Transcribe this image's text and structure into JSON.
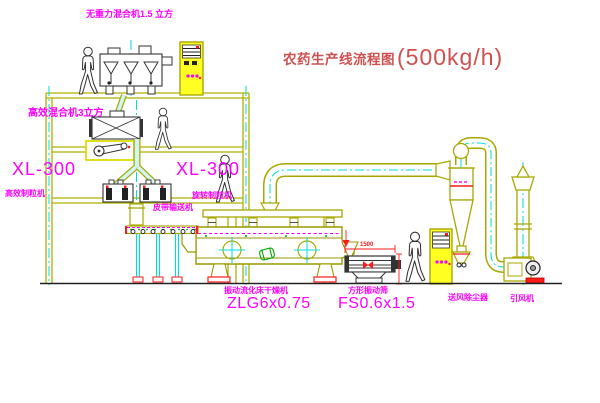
{
  "title": {
    "name": "农药生产线流程图",
    "capacity": "(500kg/h)"
  },
  "labels": {
    "top_mixer": "无重力混合机1.5 立方",
    "floor_mixer": "高效混合机3立方",
    "granulator_left_model": "XL-300",
    "granulator_left_name": "高效制粒机",
    "granulator_right_model": "XL-300",
    "granulator_right_name": "旋转制粒机",
    "belt_conveyor": "皮带输送机",
    "dryer_name": "振动流化床干燥机",
    "dryer_model": "ZLG6x0.75",
    "sieve_name": "方形振动筛",
    "sieve_model": "FS0.6x1.5",
    "sieve_dim_width": "1500",
    "dust_collector": "送风除尘器",
    "fan": "引风机"
  },
  "colors": {
    "structure_yellow": "#B0B000",
    "label_magenta": "#FF00FF",
    "centerline_cyan": "#00DCDC",
    "accent_red": "#FF1A1A",
    "title_red": "#D05050",
    "cabinet_yellow": "#FFFF22",
    "detail_green": "#00A800"
  }
}
